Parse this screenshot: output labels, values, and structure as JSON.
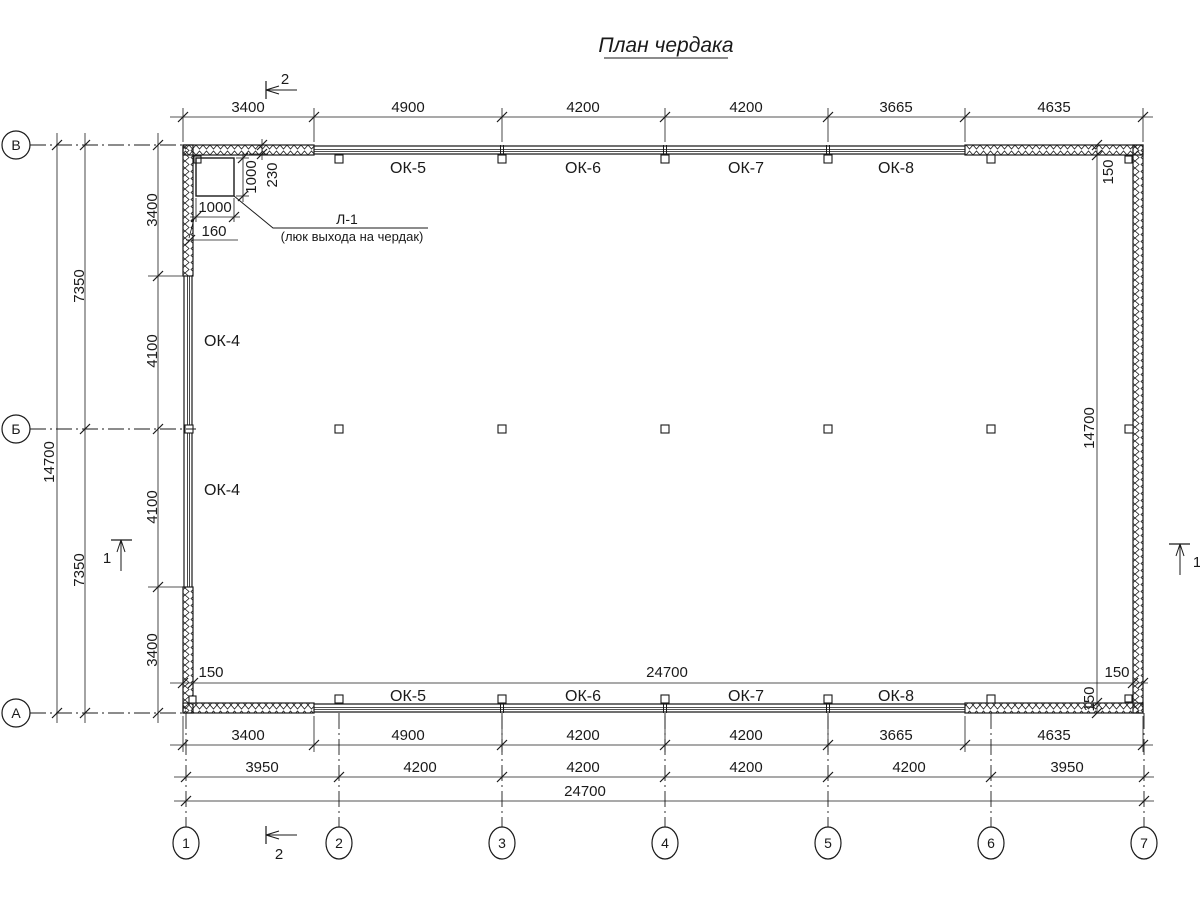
{
  "title": "План чердака",
  "colors": {
    "line": "#1a1a1a",
    "background": "#ffffff"
  },
  "axes": {
    "rows": [
      "В",
      "Б",
      "А"
    ],
    "cols": [
      "1",
      "2",
      "3",
      "4",
      "5",
      "6",
      "7"
    ]
  },
  "sections": {
    "s1": "1",
    "s2": "2"
  },
  "dims": {
    "top": [
      "3400",
      "4900",
      "4200",
      "4200",
      "3665",
      "4635"
    ],
    "bottom_row1": [
      "3400",
      "4900",
      "4200",
      "4200",
      "3665",
      "4635"
    ],
    "bottom_row2": [
      "3950",
      "4200",
      "4200",
      "4200",
      "4200",
      "3950"
    ],
    "bottom_total": "24700",
    "left_outer": [
      "3400",
      "4100",
      "4100",
      "3400"
    ],
    "left_mid": [
      "7350",
      "7350"
    ],
    "left_total": "14700",
    "inner_width": "24700",
    "inner_height": "14700",
    "wall_thickness": "150",
    "hatch_1000_v": "1000",
    "hatch_230": "230",
    "hatch_1000_h": "1000",
    "hatch_160": "160"
  },
  "labels": {
    "windows_top": [
      "ОК-5",
      "ОК-6",
      "ОК-7",
      "ОК-8"
    ],
    "windows_bottom": [
      "ОК-5",
      "ОК-6",
      "ОК-7",
      "ОК-8"
    ],
    "windows_left": [
      "ОК-4",
      "ОК-4"
    ],
    "hatch_name": "Л-1",
    "hatch_desc": "(люк выхода на чердак)"
  }
}
